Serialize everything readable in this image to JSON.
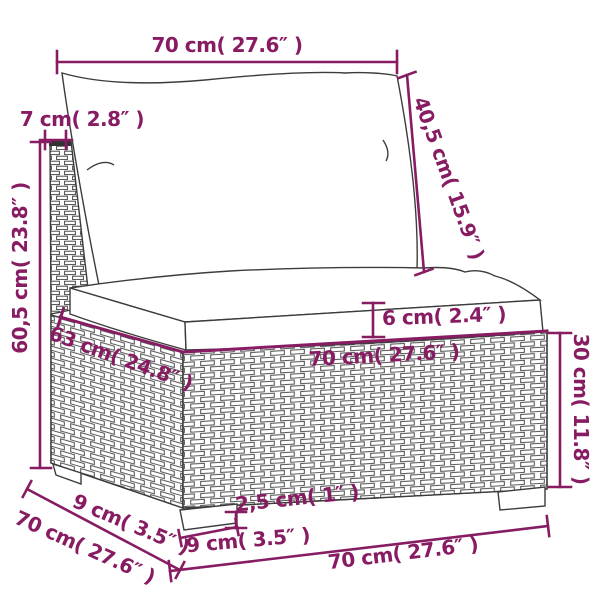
{
  "diagram_type": "furniture-dimension-diagram",
  "product": "rattan-sectional-sofa-middle-seat-with-cushions",
  "colors": {
    "accent": "#871C63",
    "line_art": "#3C3C3C",
    "weave_stroke": "#4A4A4A",
    "background": "#FFFFFF"
  },
  "labels": {
    "top_width": "70 cm( 27.6″ )",
    "back_cushion_height": "40,5 cm( 15.9″ )",
    "back_panel_thickness": "7 cm( 2.8″ )",
    "overall_height": "60,5 cm( 23.8″ )",
    "seat_depth": "63 cm( 24.8″ )",
    "seat_width": "70 cm( 27.6″ )",
    "cushion_thickness": "6 cm( 2.4″ )",
    "base_height": "30 cm( 11.8″ )",
    "foot_inset_depth": "9 cm( 3.5″ )",
    "base_depth": "70 cm( 27.6″ )",
    "foot_height": "2,5 cm( 1″ )",
    "foot_width": "9 cm( 3.5″ )",
    "base_width": "70 cm( 27.6″ )"
  }
}
